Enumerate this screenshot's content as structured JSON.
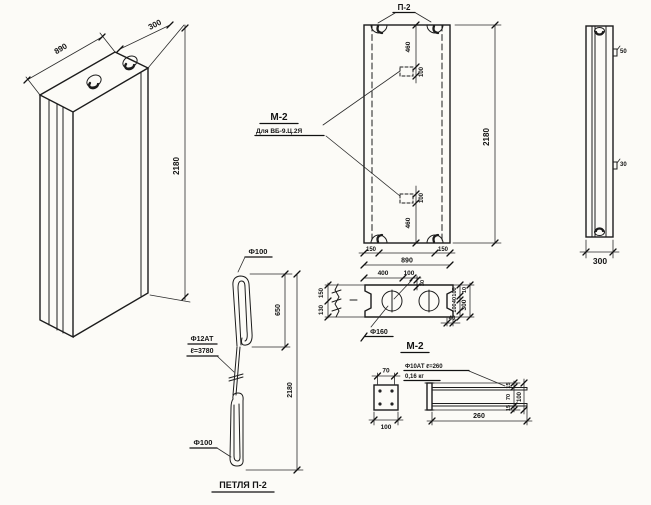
{
  "iso": {
    "dim_width": "890",
    "dim_depth": "300",
    "dim_height": "2180"
  },
  "front": {
    "loop_ref": "П-2",
    "anchor_ref": "М-2",
    "anchor_note": "Для ВБ-9.Ц.2Я",
    "dim_top_offset": "460",
    "dim_top_plate": "100",
    "dim_bottom_plate": "100",
    "dim_bottom_offset": "460",
    "dim_height": "2180",
    "dim_margin_left": "150",
    "dim_width": "890",
    "dim_margin_right": "150",
    "dim_400": "400",
    "dim_100": "100",
    "dim_30": "30"
  },
  "plan": {
    "hole_dia": "Ф160",
    "left_top": "150",
    "left_bottom": "130",
    "right_100a": "100",
    "right_40": "40",
    "right_100b": "100",
    "right_10": "10",
    "right_300": "300",
    "notch_40": "40"
  },
  "side": {
    "anchor_top": "50",
    "anchor_mid": "30",
    "dim_depth": "300"
  },
  "loop_detail": {
    "top_dia": "Ф100",
    "dim_650": "650",
    "dim_height": "2180",
    "bar_spec": "Ф12АТ",
    "bar_length": "ℓ=3780",
    "bottom_dia": "Ф100",
    "title": "ПЕТЛЯ П-2"
  },
  "m2_detail": {
    "title": "М-2",
    "dim_70": "70",
    "dim_100": "100",
    "bar_spec": "Ф10АТ ℓ=260",
    "weight": "0,16 кг",
    "dim_260": "260",
    "dim_15a": "15",
    "dim_70b": "70",
    "dim_15b": "15",
    "dim_100b": "100"
  }
}
